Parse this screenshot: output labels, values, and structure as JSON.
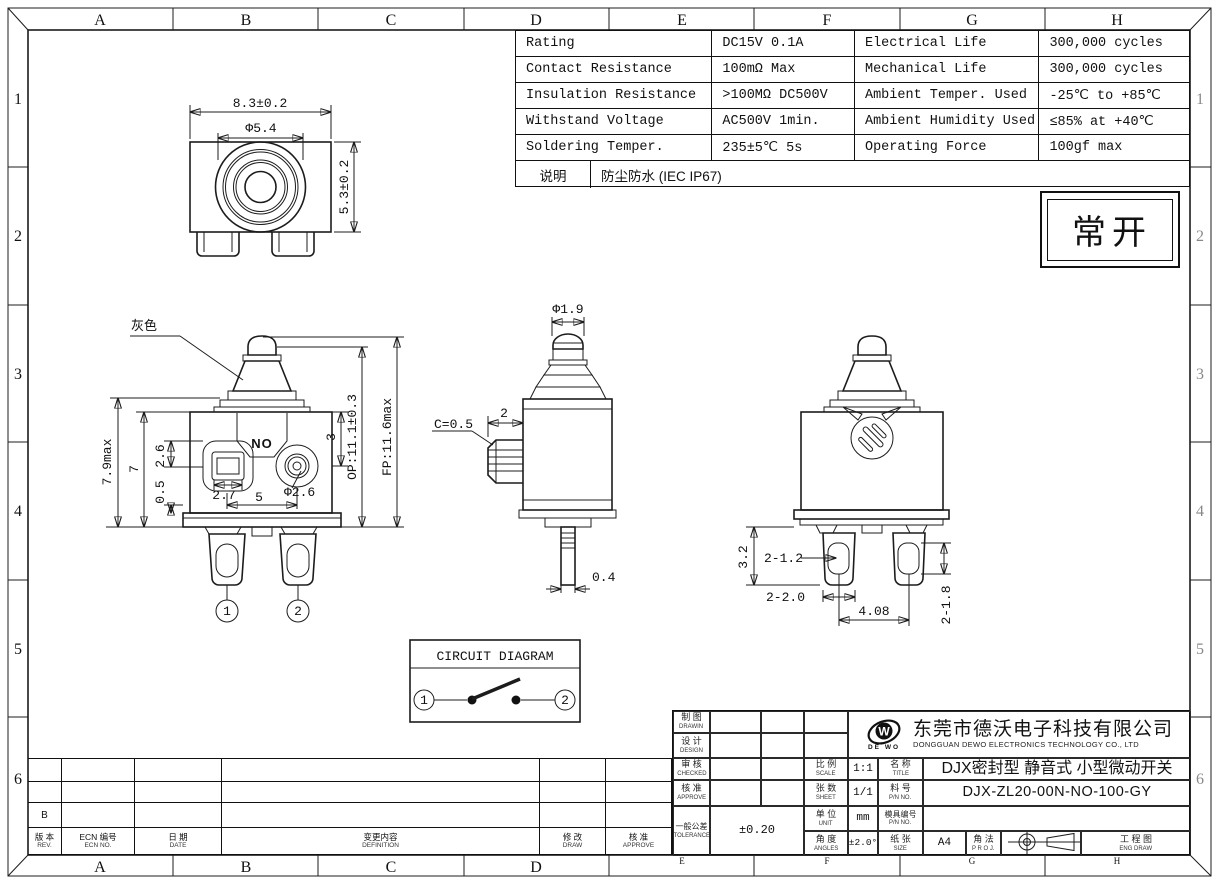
{
  "sheet": {
    "zones_top": [
      "A",
      "B",
      "C",
      "D",
      "E",
      "F",
      "G",
      "H"
    ],
    "zones_bottom": [
      "A",
      "B",
      "C",
      "D",
      "E",
      "F",
      "G",
      "H"
    ],
    "zones_left": [
      "1",
      "2",
      "3",
      "4",
      "5",
      "6"
    ],
    "zones_right": [
      "1",
      "2",
      "3",
      "4",
      "5",
      "6"
    ]
  },
  "spec_table": {
    "rows": [
      {
        "label1": "Rating",
        "value1": "DC15V 0.1A",
        "label2": "Electrical Life",
        "value2": "300,000 cycles"
      },
      {
        "label1": "Contact Resistance",
        "value1": "100mΩ Max",
        "label2": "Mechanical Life",
        "value2": "300,000 cycles"
      },
      {
        "label1": "Insulation Resistance",
        "value1": ">100MΩ DC500V",
        "label2": "Ambient Temper. Used",
        "value2": "-25℃ to +85℃"
      },
      {
        "label1": "Withstand Voltage",
        "value1": "AC500V 1min.",
        "label2": "Ambient Humidity Used",
        "value2": "≤85% at +40℃"
      },
      {
        "label1": "Soldering Temper.",
        "value1": "235±5℃ 5s",
        "label2": "Operating Force",
        "value2": "100gf max"
      }
    ],
    "note_label": "说明",
    "note_value": "防尘防水 (IEC IP67)"
  },
  "state_box": {
    "text": "常开"
  },
  "top_view": {
    "dim_width": "8.3±0.2",
    "dim_circle": "Φ5.4",
    "dim_height": "5.3±0.2"
  },
  "front_view": {
    "color_label": "灰色",
    "marking": "NO",
    "dim_height_max": "7.9max",
    "dim_height": "7",
    "dim_26": "2.6",
    "dim_05": "0.5",
    "dim_27": "2.7",
    "dim_5": "5",
    "dim_phi26": "Φ2.6",
    "dim_3": "3",
    "dim_op": "OP:11.1±0.3",
    "dim_fp": "FP:11.6max",
    "terminal_1": "1",
    "terminal_2": "2"
  },
  "side_view": {
    "dim_phi19": "Φ1.9",
    "dim_chamfer": "C=0.5",
    "dim_2": "2",
    "dim_04": "0.4"
  },
  "back_view": {
    "dim_32": "3.2",
    "dim_2x12": "2-1.2",
    "dim_2x20": "2-2.0",
    "dim_408": "4.08",
    "dim_2x18": "2-1.8"
  },
  "circuit": {
    "title": "CIRCUIT DIAGRAM",
    "node_1": "1",
    "node_2": "2"
  },
  "title_block": {
    "drawn_cn": "制 图",
    "drawn_en": "DRAWIN",
    "design_cn": "设 计",
    "design_en": "DESIGN",
    "checked_cn": "审 核",
    "checked_en": "CHECKED",
    "approve_cn": "核 准",
    "approve_en": "APPROVE",
    "tolerance_cn": "一般公差",
    "tolerance_en": "TOLERANCE",
    "tolerance_value": "±0.20",
    "scale_cn": "比 例",
    "scale_en": "SCALE",
    "scale_value": "1:1",
    "sheet_cn": "张 数",
    "sheet_en": "SHEET",
    "sheet_value": "1/1",
    "unit_cn": "单 位",
    "unit_en": "UNIT",
    "unit_value": "mm",
    "angles_cn": "角 度",
    "angles_en": "ANGLES",
    "angles_value": "±2.0°",
    "name_cn": "名 称",
    "name_en": "TITLE",
    "name_value": "DJX密封型 静音式 小型微动开关",
    "pn_cn": "料 号",
    "pn_en": "P/N NO.",
    "pn_value": "DJX-ZL20-00N-NO-100-GY",
    "mold_cn": "模具编号",
    "mold_en": "P/N NO.",
    "size_cn": "纸 张",
    "size_en": "SIZE",
    "size_value": "A4",
    "proj_cn": "角 法",
    "proj_en": "P R O J.",
    "engdraw_cn": "工 程 图",
    "engdraw_en": "ENG DRAW",
    "company_cn": "东莞市德沃电子科技有限公司",
    "company_en": "DONGGUAN DEWO ELECTRONICS TECHNOLOGY CO., LTD",
    "logo_w": "W",
    "logo_text": "DE WO"
  },
  "revision": {
    "rev_cn": "版 本",
    "rev_en": "REV.",
    "ecn_cn": "ECN 编号",
    "ecn_en": "ECN NO.",
    "date_cn": "日 期",
    "date_en": "DATE",
    "definition_cn": "变更内容",
    "definition_en": "DEFINITION",
    "draw_cn": "修 改",
    "draw_en": "DRAW",
    "approve_cn": "核 准",
    "approve_en": "APPROVE",
    "rows": [
      {
        "rev": ""
      },
      {
        "rev": ""
      },
      {
        "rev": "B"
      }
    ]
  }
}
